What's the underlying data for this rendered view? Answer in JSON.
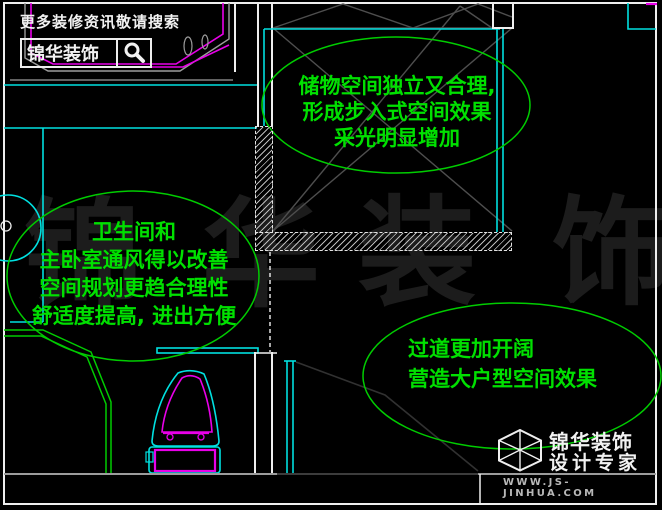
{
  "colors": {
    "background": "#000000",
    "annotation_green": "#00E000",
    "line_green": "#00CC00",
    "cyan": "#00E0E0",
    "magenta": "#E800E8",
    "white": "#EFEFEF",
    "gray_line": "#9C9C9C",
    "hatch_gray": "#4E4E4E",
    "watermark": "#1C1C1C",
    "website_gray": "#B8B8B8"
  },
  "banner": {
    "tagline": "更多装修资讯敬请搜索",
    "brand": "锦华装饰",
    "search_icon": "magnifier"
  },
  "annotations": {
    "closet": {
      "lines": [
        "储物空间独立又合理,",
        "形成步入式空间效果",
        "采光明显增加"
      ]
    },
    "bathroom": {
      "lines": [
        "卫生间和",
        "主卧室通风得以改善",
        "空间规划更趋合理性",
        "舒适度提高, 进出方便"
      ]
    },
    "hallway": {
      "lines": [
        "过道更加开阔",
        "营造大户型空间效果"
      ]
    }
  },
  "watermark": {
    "char1": "锦",
    "char2": "华",
    "char3": "装",
    "char4": "饰"
  },
  "logo": {
    "brand": "锦华装饰",
    "tagline": "设计专家",
    "website": "WWW.JS-JINHUA.COM"
  }
}
